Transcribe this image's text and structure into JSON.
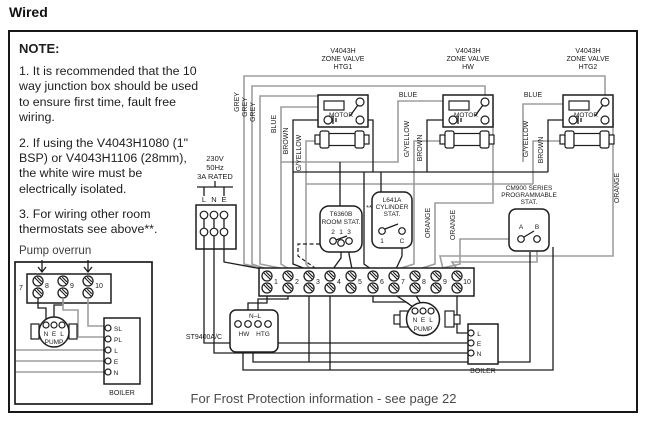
{
  "page": {
    "title": "Wired",
    "footer": "For Frost Protection information - see page 22"
  },
  "note": {
    "heading": "NOTE:",
    "items": [
      "1. It is recommended that the 10 way junction box should be used to ensure first time, fault free wiring.",
      "2. If using the V4043H1080 (1\" BSP) or V4043H1106 (28mm), the white wire must be electrically isolated.",
      "3. For wiring other room thermostats see above**."
    ]
  },
  "valves": [
    {
      "model": "V4043H",
      "type": "ZONE VALVE",
      "zone": "HTG1",
      "motor": "MOTOR"
    },
    {
      "model": "V4043H",
      "type": "ZONE VALVE",
      "zone": "HW",
      "motor": "MOTOR"
    },
    {
      "model": "V4043H",
      "type": "ZONE VALVE",
      "zone": "HTG2",
      "motor": "MOTOR"
    }
  ],
  "wire_labels": {
    "grey": "GREY",
    "blue": "BLUE",
    "brown": "BROWN",
    "gyellow": "G/YELLOW",
    "orange": "ORANGE"
  },
  "supply": {
    "volts": "230V",
    "freq": "50Hz",
    "rating": "3A RATED",
    "l": "L",
    "n": "N",
    "e": "E"
  },
  "room_stat": {
    "model": "T6360B",
    "name": "ROOM STAT.",
    "t2": "2",
    "t1": "1",
    "t3": "3",
    "marker": "**"
  },
  "cylinder_stat": {
    "model": "L641A",
    "name1": "CYLINDER",
    "name2": "STAT.",
    "t1": "1",
    "tc": "C"
  },
  "prog_stat": {
    "line1": "CM900 SERIES",
    "line2": "PROGRAMMABLE",
    "line3": "STAT.",
    "ta": "A",
    "tb": "B"
  },
  "junction_box": {
    "terminals": [
      "1",
      "2",
      "3",
      "4",
      "5",
      "6",
      "7",
      "8",
      "9",
      "10"
    ]
  },
  "programmer": {
    "label": "ST9400A/C",
    "top": "N–L",
    "hw": "HW",
    "htg": "HTG"
  },
  "pump": {
    "n": "N",
    "e": "E",
    "l": "L",
    "label": "PUMP"
  },
  "boiler": {
    "label": "BOILER",
    "l": "L",
    "e": "E",
    "n": "N"
  },
  "pump_overrun": {
    "title": "Pump overrun",
    "t7": "7",
    "t8": "8",
    "t9": "9",
    "t10": "10",
    "pump": {
      "n": "N",
      "e": "E",
      "l": "L",
      "label": "PUMP"
    },
    "boiler": {
      "label": "BOILER",
      "sl": "SL",
      "pl": "PL",
      "l": "L",
      "e": "E",
      "n": "N"
    }
  }
}
